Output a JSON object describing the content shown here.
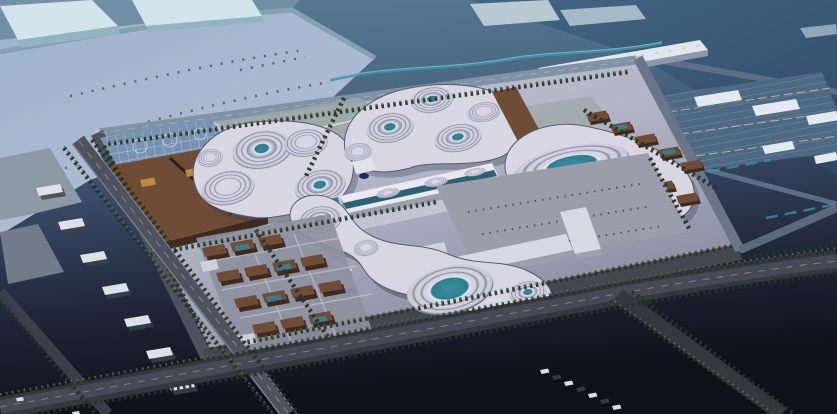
{
  "scene": {
    "description": "Dusk aerial rendering of a campus master plan: four organic terraced pavilions with teal oval skylights, a brown exhibition hall, a brick village block, a central gallery building and plaza, surrounded by tree-lined roads, warehouse rows, a parking grid and a winding stream",
    "view": "isometric aerial"
  },
  "palette": {
    "bg_top": "#5a7d93",
    "bg_upper": "#4a6782",
    "bg_mid": "#33415c",
    "bg_low": "#1d2333",
    "bg_bottom": "#0e1119",
    "tr_dark_1": "#416483",
    "tr_dark_2": "#2e4a66",
    "field_1": "#9cb3ca",
    "field_2": "#b6bdd6",
    "slab_pale": "#d2e4eb",
    "slab_face": "#94b3c0",
    "distant_slab": "#b7c9d2",
    "site_1": "#c6c8d8",
    "site_2": "#b2b4c6",
    "site_3": "#85889b",
    "lawn": "#9aa6a6",
    "shell": "#d9d6e3",
    "shell_edge": "#4e5268",
    "ring": "#81869c",
    "glass_teal": "#35889a",
    "brown_roof": "#6e4c35",
    "brown_dark": "#3f2b1e",
    "tan": "#c08a3e",
    "teal_glass_roof": "#3a7d8c",
    "glass_lattice": "#7792b2",
    "central_roof": "#eae9f1",
    "central_face": "#9aa0af",
    "glass_band": "#2a6375",
    "plaza": "#9c9daa",
    "plaza_bldg": "#d6d9e3",
    "plaza_bldg_face": "#9aa0ae",
    "village_pad": "#8d909f",
    "linear_white": "#e0e6ed",
    "warehouse_white": "#e3e9ef",
    "parking_blue": "#4d6983",
    "river": "#3e92a4",
    "road_top": "#7e93a6",
    "road_left": "#4e525e",
    "road_bottom": "#43474f",
    "road_right": "#6b7587",
    "road_inner": "#a6a8b4",
    "road_main": "#35383f",
    "road_center": "#464a55",
    "road_far": "#5a6a7e",
    "tree_dark": "#263527",
    "tree_light": "#5d7a55",
    "shed_white": "#dce0e7",
    "gray_slab": "#8e99a7",
    "boat_blue": "#2b55c4",
    "rock_red": "#7c3726",
    "rock_navy": "#1c2f52",
    "car_light": "#d9dde3",
    "car_dark": "#333b49",
    "walk_light": "#c9ccd9"
  }
}
